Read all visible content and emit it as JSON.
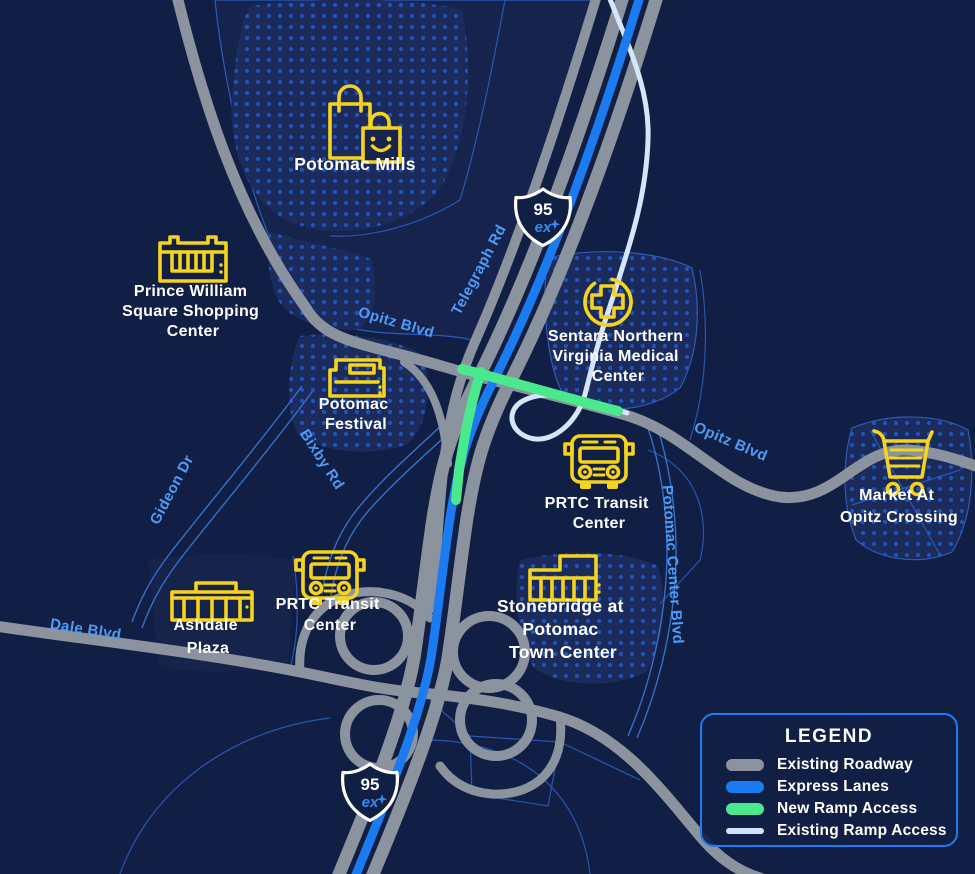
{
  "map": {
    "shield": {
      "route": "95",
      "brand": "ex"
    },
    "road_labels": {
      "telegraph": "Telegraph Rd",
      "opitz_west": "Opitz Blvd",
      "opitz_east": "Opitz Blvd",
      "bixby": "Bixby Rd",
      "gideon": "Gideon Dr",
      "dale": "Dale Blvd",
      "potomac_center": "Potomac Center Blvd"
    },
    "landmarks": [
      {
        "id": "potomac-mills",
        "icon": "shopping-bags-icon",
        "lines": [
          "Potomac Mills"
        ]
      },
      {
        "id": "prince-william-square",
        "icon": "storefront-icon",
        "lines": [
          "Prince William",
          "Square Shopping",
          "Center"
        ]
      },
      {
        "id": "sentara-medical",
        "icon": "medical-cross-icon",
        "lines": [
          "Sentara Northern",
          "Virginia Medical",
          "Center"
        ]
      },
      {
        "id": "potomac-festival",
        "icon": "festival-store-icon",
        "lines": [
          "Potomac",
          "Festival"
        ]
      },
      {
        "id": "prtc-transit-east",
        "icon": "bus-icon",
        "lines": [
          "PRTC Transit",
          "Center"
        ]
      },
      {
        "id": "market-at-opitz",
        "icon": "shopping-cart-icon",
        "lines": [
          "Market At",
          "Opitz Crossing"
        ]
      },
      {
        "id": "stonebridge",
        "icon": "shops-icon",
        "lines": [
          "Stonebridge at",
          "Potomac",
          "Town Center"
        ]
      },
      {
        "id": "prtc-transit-west",
        "icon": "bus-icon",
        "lines": [
          "PRTC Transit",
          "Center"
        ]
      },
      {
        "id": "ashdale-plaza",
        "icon": "mall-icon",
        "lines": [
          "Ashdale",
          "Plaza"
        ]
      }
    ]
  },
  "legend": {
    "title": "LEGEND",
    "items": [
      {
        "label": "Existing Roadway",
        "color": "#8b939e"
      },
      {
        "label": "Express Lanes",
        "color": "#1b7cf2"
      },
      {
        "label": "New Ramp Access",
        "color": "#4ae98e"
      },
      {
        "label": "Existing Ramp Access",
        "color": "#cfe4f8"
      }
    ]
  }
}
